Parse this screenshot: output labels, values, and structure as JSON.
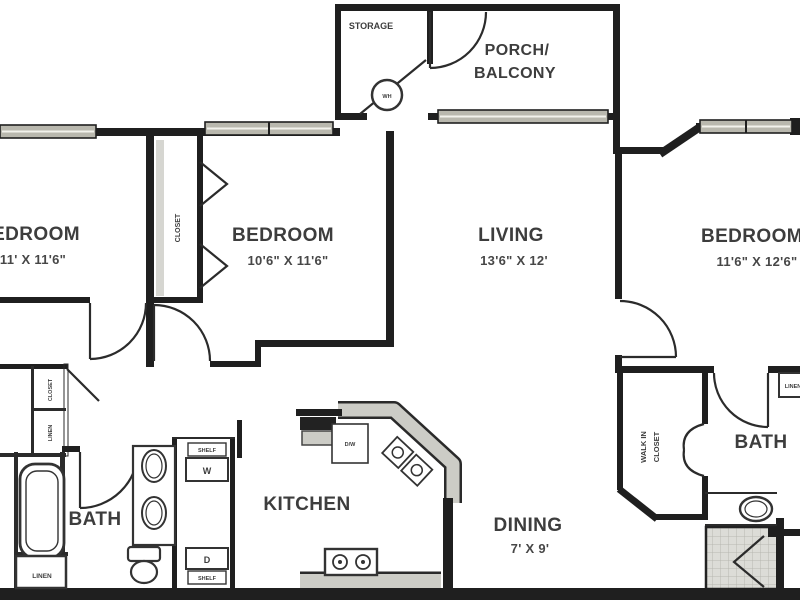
{
  "plan": {
    "rooms": {
      "storage": {
        "label": "STORAGE"
      },
      "porch": {
        "label_line1": "PORCH/",
        "label_line2": "BALCONY"
      },
      "bedroom_left": {
        "label": "BEDROOM",
        "dims": "11' X 11'6\""
      },
      "bedroom_middle": {
        "label": "BEDROOM",
        "dims": "10'6\" X 11'6\""
      },
      "living": {
        "label": "LIVING",
        "dims": "13'6\" X 12'"
      },
      "bedroom_right": {
        "label": "BEDROOM",
        "dims": "11'6\" X 12'6\""
      },
      "bath_left": {
        "label": "BATH"
      },
      "bath_right": {
        "label": "BATH"
      },
      "kitchen": {
        "label": "KITCHEN"
      },
      "dining": {
        "label": "DINING",
        "dims": "7' X 9'"
      }
    },
    "small_labels": {
      "water_heater": "WH",
      "bedroom_closet": "CLOSET",
      "entry_closet": "CLOSET",
      "entry_linen": "LINEN",
      "bath_linen": "LINEN",
      "right_linen": "LINEN",
      "walk_in_line1": "WALK IN",
      "walk_in_line2": "CLOSET",
      "washer": "W",
      "dryer": "D",
      "shelf_top": "SHELF",
      "shelf_bottom": "SHELF",
      "dishwasher": "D/W"
    },
    "colors": {
      "wall": "#1f1f1f",
      "window_glass": "#b9b8ae",
      "counter": "#ccccc6",
      "tile": "#dcdcd7",
      "text": "#3d3d3d"
    }
  }
}
